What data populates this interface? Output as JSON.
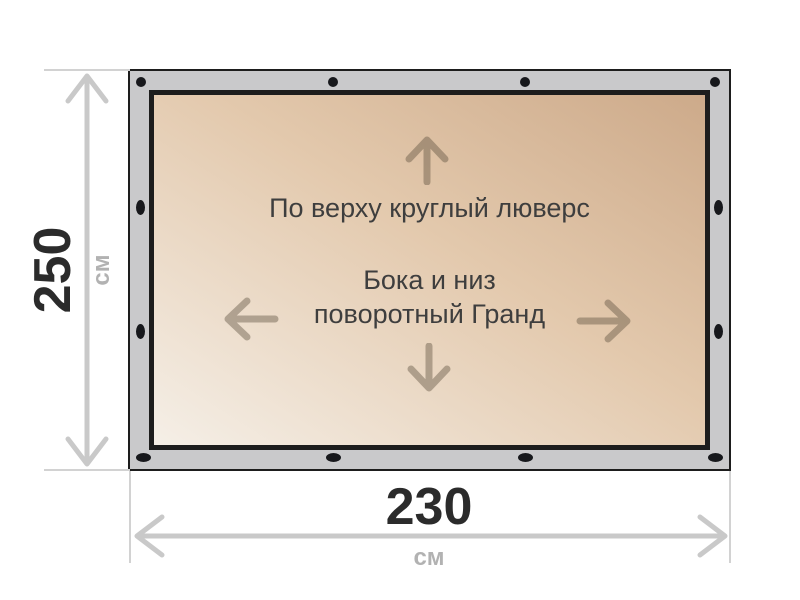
{
  "panel": {
    "top_note": "По верху круглый люверс",
    "middle_note_line1": "Бока и низ",
    "middle_note_line2": "поворотный Гранд"
  },
  "dimensions": {
    "height_value": "250",
    "height_unit": "см",
    "width_value": "230",
    "width_unit": "см"
  },
  "icons": {
    "panel_arrows": [
      "up-arrow-icon",
      "left-arrow-icon",
      "right-arrow-icon",
      "down-arrow-icon"
    ],
    "grommet": "grommet-icon",
    "dimension_arrows": [
      "height-dimension-arrow-icon",
      "width-dimension-arrow-icon"
    ]
  },
  "colors": {
    "frame_gray": "#c9c9cb",
    "frame_border": "#1d1d1d",
    "grommet": "#17181c",
    "panel_gradient_light": "#f5efe7",
    "panel_gradient_mid": "#e3c9ad",
    "panel_gradient_dark": "#cdaa8a",
    "panel_text": "#3e3e3e",
    "panel_arrow": "rgba(84,72,56,0.40)",
    "dimension_line": "#c9c9c9",
    "dimension_tick": "#d2d2d2",
    "dimension_value_text": "#2b2b2b",
    "dimension_unit_text": "#b2b2b2"
  }
}
